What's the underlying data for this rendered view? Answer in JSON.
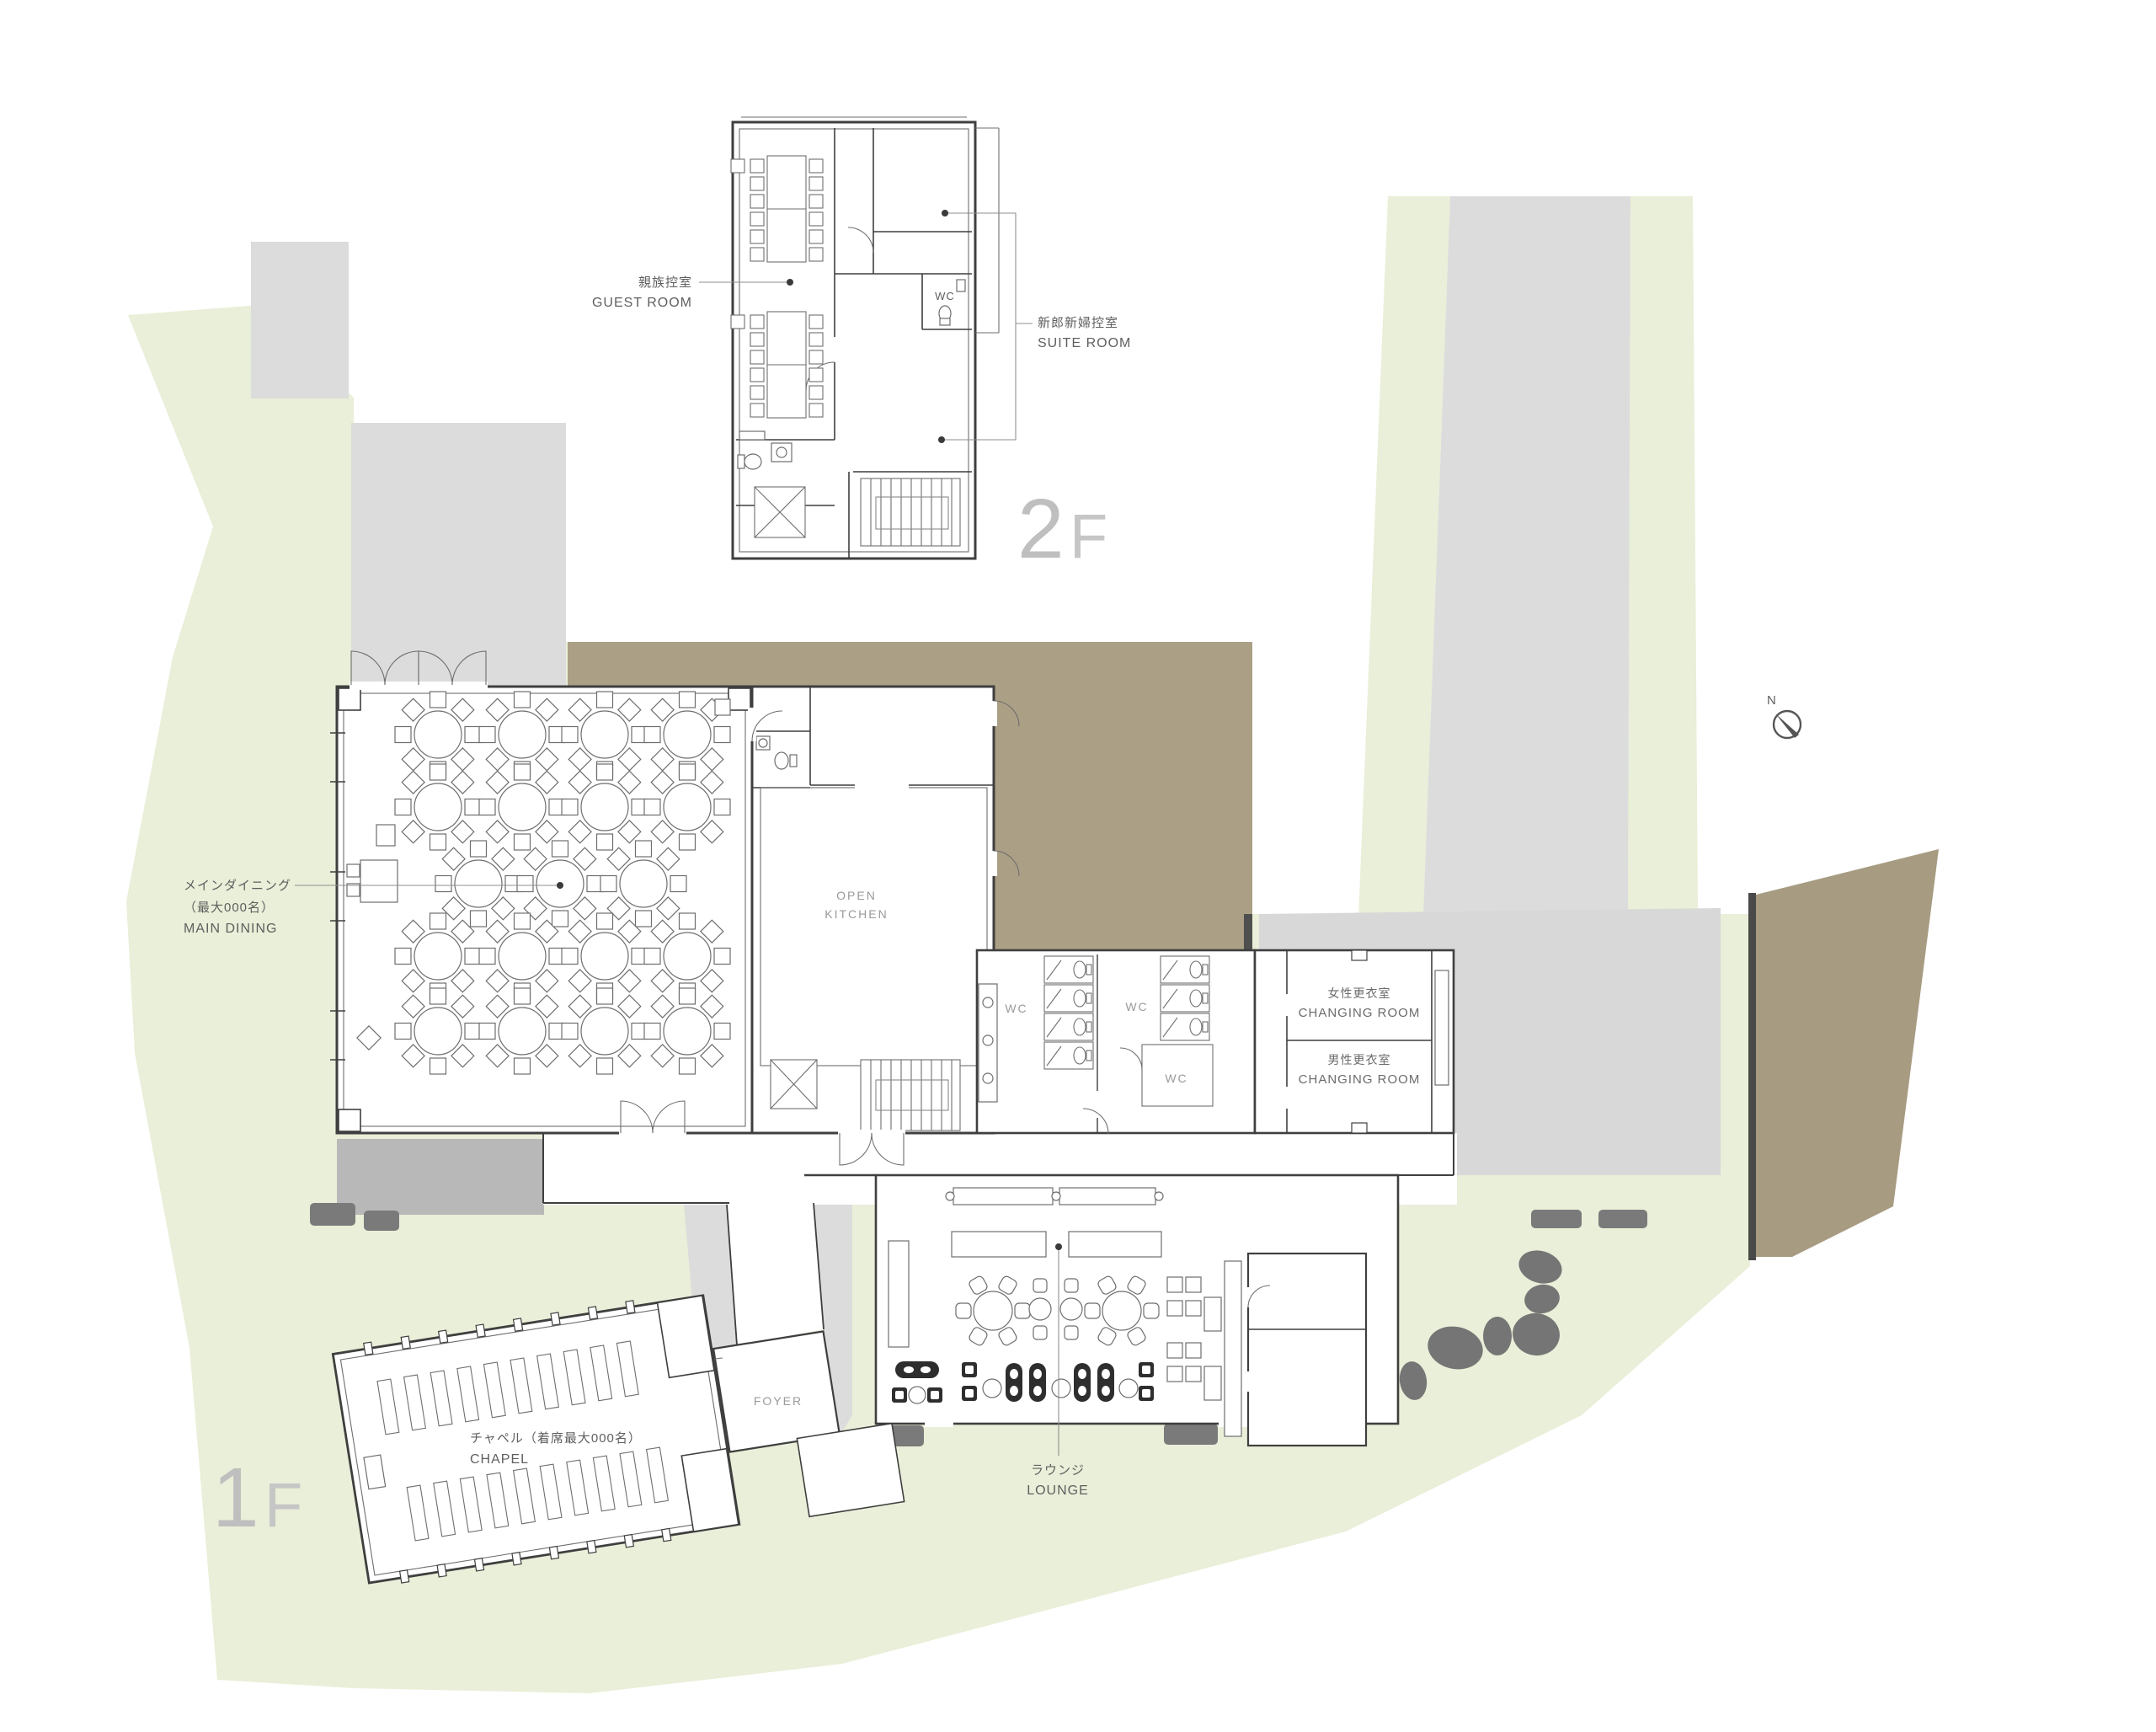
{
  "title": "Wedding venue floor plan 1F / 2F",
  "colors": {
    "site_green": "#e9efd8",
    "paving_gray": "#dcdcdc",
    "plaza_gray": "#d8d8d8",
    "terrace_brown": "#ab9f85",
    "terrace_dark_gray": "#b8b8b8",
    "wall_dark": "#4a4a4a",
    "rock_gray": "#757575",
    "line_color": "#3f3f3f"
  },
  "floor2": {
    "guest_room_ja": "親族控室",
    "guest_room_en": "GUEST ROOM",
    "suite_ja": "新郎新婦控室",
    "suite_en": "SUITE ROOM",
    "wc": "WC",
    "tag_num": "2",
    "tag_letter": "F"
  },
  "floor1": {
    "main_dining_ja": "メインダイニング",
    "main_dining_capacity": "（最大000名）",
    "main_dining_en": "MAIN DINING",
    "open_kitchen_line1": "OPEN",
    "open_kitchen_line2": "KITCHEN",
    "wc1": "WC",
    "wc2": "WC",
    "wc3": "WC",
    "women_changing_ja": "女性更衣室",
    "women_changing_en": "CHANGING ROOM",
    "men_changing_ja": "男性更衣室",
    "men_changing_en": "CHANGING ROOM",
    "foyer": "FOYER",
    "chapel_ja": "チャペル（着席最大000名）",
    "chapel_en": "CHAPEL",
    "lounge_ja": "ラウンジ",
    "lounge_en": "LOUNGE",
    "tag_num": "1",
    "tag_letter": "F"
  },
  "compass": {
    "label": "N"
  }
}
